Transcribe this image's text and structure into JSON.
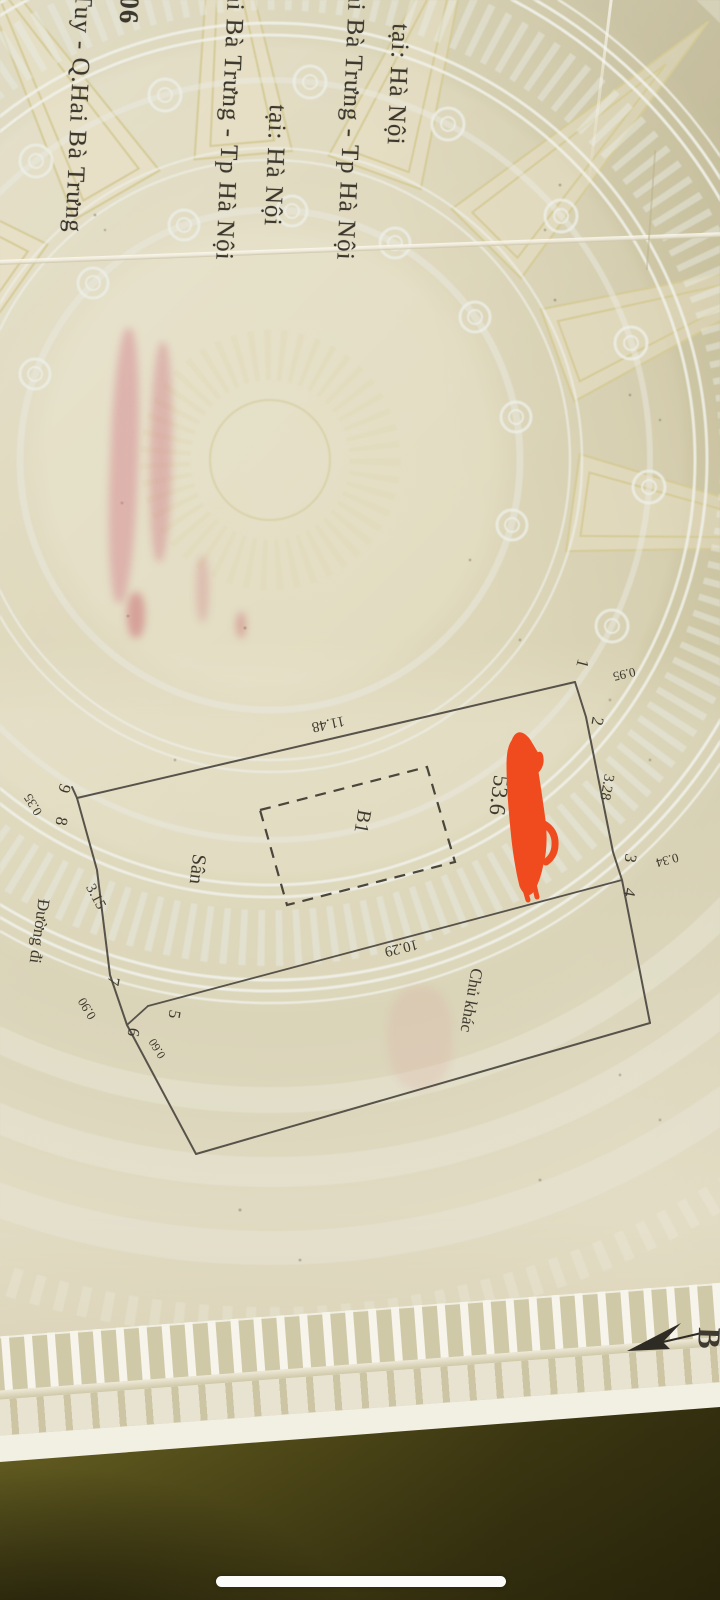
{
  "header": {
    "col1": "tại: Hà Nội",
    "col2": "ai Bà Trưng - Tp Hà Nội",
    "col3": "tại: Hà Nội",
    "col4": "ai Bà Trưng - Tp Hà Nội",
    "col5": "06",
    "col6": "Tuy - Q.Hai Bà Trưng"
  },
  "diagram": {
    "v1": "1",
    "v2": "2",
    "v3": "3",
    "v4": "4",
    "v5": "5",
    "v6": "6",
    "v7": "7",
    "v8": "8",
    "v9": "9",
    "d095": "0.95",
    "d328": "3.28",
    "d034": "0.34",
    "d1148": "11.48",
    "d1029": "10.29",
    "d315": "3.15",
    "d090": "0.90",
    "d060": "0.60",
    "d035": "0.35",
    "area": "53.6",
    "building": "B1",
    "yard": "Sân",
    "neighbor": "Chủ khác",
    "road": "Đường đi",
    "north": "B"
  },
  "colors": {
    "paper_cream": "#e3ddc3",
    "pattern_tan": "#cfc8a8",
    "watermark_white": "#eceee6",
    "ray_yellow": "#d4ca97",
    "ink_text": "#3d382d",
    "plot_line": "#57534a",
    "red_scribble": "#f04b1e",
    "stamp_pink": "#d98f9b",
    "table_olive": "#5d561e",
    "home_indicator": "#fcfcfb"
  }
}
